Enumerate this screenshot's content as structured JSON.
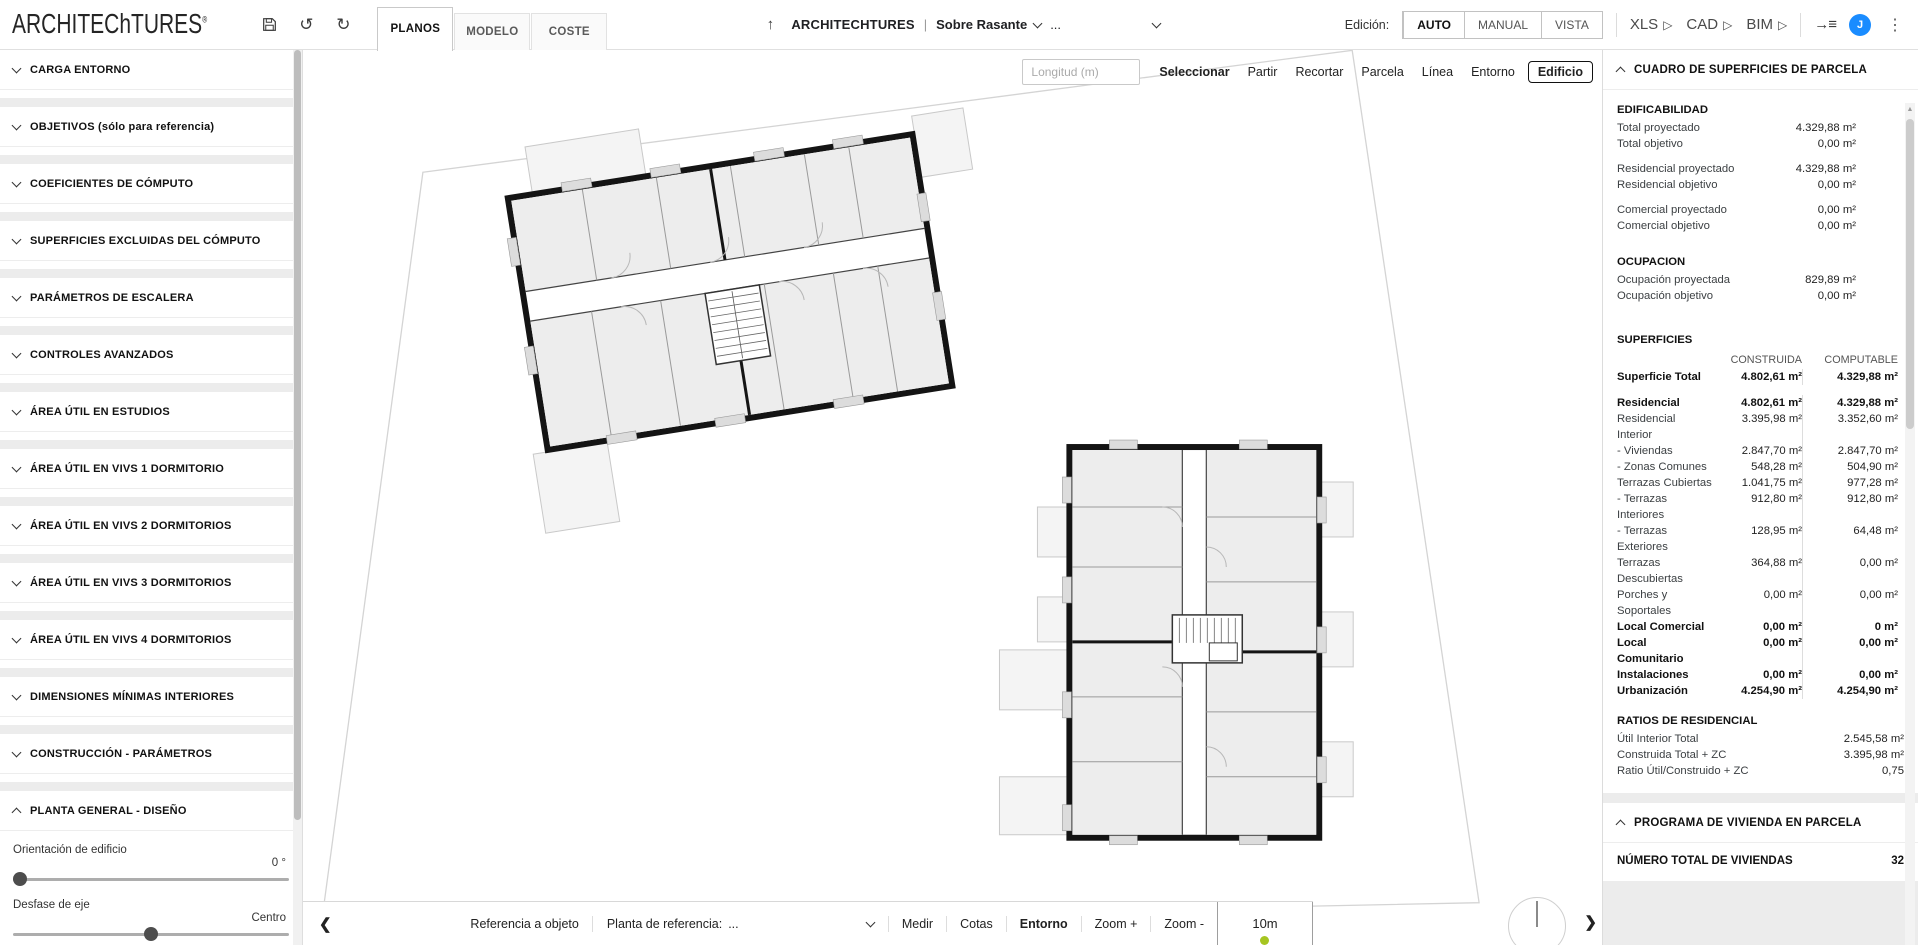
{
  "icons": {
    "up_arrow": "↑",
    "undo": "↺",
    "redo": "↻",
    "kebab": "⋮",
    "chevron_left": "❮",
    "chevron_right": "❯",
    "play": "▷",
    "arrow_right": "→",
    "list": "≡",
    "scroll_up": "▲"
  },
  "colors": {
    "avatar_blue": "#1a8cff",
    "scale_dot_green": "#a6c521",
    "wall_black": "#141414"
  },
  "topbar": {
    "logo": "ARCHITEChTURES",
    "logo_mark": "®",
    "tabs": [
      {
        "label": "PLANOS",
        "active": true
      },
      {
        "label": "MODELO",
        "active": false
      },
      {
        "label": "COSTE",
        "active": false
      }
    ],
    "project_name": "ARCHITECHTURES",
    "separator": "|",
    "level_selector": "Sobre Rasante",
    "sublevel_selector": "...",
    "edition_label": "Edición:",
    "edition_modes": [
      {
        "label": "AUTO",
        "active": true
      },
      {
        "label": "MANUAL",
        "active": false
      },
      {
        "label": "VISTA",
        "active": false
      }
    ],
    "exports": [
      {
        "label": "XLS"
      },
      {
        "label": "CAD"
      },
      {
        "label": "BIM"
      }
    ],
    "avatar_initial": "J"
  },
  "sidebar": {
    "sections": [
      {
        "label": "CARGA ENTORNO"
      },
      {
        "label": "OBJETIVOS (sólo para referencia)"
      },
      {
        "label": "COEFICIENTES DE CÓMPUTO"
      },
      {
        "label": "SUPERFICIES EXCLUIDAS DEL CÓMPUTO"
      },
      {
        "label": "PARÁMETROS DE ESCALERA"
      },
      {
        "label": "CONTROLES AVANZADOS"
      },
      {
        "label": "ÁREA ÚTIL EN ESTUDIOS"
      },
      {
        "label": "ÁREA ÚTIL EN VIVS 1 DORMITORIO"
      },
      {
        "label": "ÁREA ÚTIL EN VIVS 2 DORMITORIOS"
      },
      {
        "label": "ÁREA ÚTIL EN VIVS 3 DORMITORIOS"
      },
      {
        "label": "ÁREA ÚTIL EN VIVS 4 DORMITORIOS"
      },
      {
        "label": "DIMENSIONES MÍNIMAS INTERIORES"
      },
      {
        "label": "CONSTRUCCIÓN - PARÁMETROS"
      }
    ],
    "expanded_section": {
      "label": "PLANTA GENERAL - DISEÑO",
      "controls": [
        {
          "label": "Orientación de edificio",
          "value": "0 °"
        },
        {
          "label": "Desfase de eje",
          "value": "Centro"
        }
      ]
    }
  },
  "canvas": {
    "toolbar": {
      "length_placeholder": "Longitud (m)",
      "tools": [
        {
          "label": "Seleccionar",
          "active": true
        },
        {
          "label": "Partir"
        },
        {
          "label": "Recortar"
        },
        {
          "label": "Parcela"
        },
        {
          "label": "Línea"
        },
        {
          "label": "Entorno"
        },
        {
          "label": "Edificio",
          "boxed": true
        }
      ]
    },
    "bottombar": {
      "ref_objeto": "Referencia a objeto",
      "planta_ref_label": "Planta de referencia:",
      "planta_ref_value": "...",
      "medir": "Medir",
      "cotas": "Cotas",
      "entorno": "Entorno",
      "zoom_in": "Zoom +",
      "zoom_out": "Zoom -",
      "scale": "10m"
    }
  },
  "right_panel": {
    "surfaces_card": {
      "title": "CUADRO DE SUPERFICIES DE PARCELA",
      "edificabilidad": {
        "title": "EDIFICABILIDAD",
        "rows": [
          {
            "label": "Total proyectado",
            "value": "4.329,88 m²"
          },
          {
            "label": "Total objetivo",
            "value": "0,00 m²"
          },
          {
            "label": "Residencial proyectado",
            "value": "4.329,88 m²",
            "gap": true
          },
          {
            "label": "Residencial objetivo",
            "value": "0,00 m²"
          },
          {
            "label": "Comercial proyectado",
            "value": "0,00 m²",
            "gap": true
          },
          {
            "label": "Comercial objetivo",
            "value": "0,00 m²"
          }
        ]
      },
      "ocupacion": {
        "title": "OCUPACION",
        "rows": [
          {
            "label": "Ocupación proyectada",
            "value": "829,89 m²"
          },
          {
            "label": "Ocupación objetivo",
            "value": "0,00 m²"
          }
        ]
      },
      "superficies": {
        "title": "SUPERFICIES",
        "col1": "CONSTRUIDA",
        "col2": "COMPUTABLE",
        "rows": [
          {
            "label": "Superficie Total",
            "c": "4.802,61 m²",
            "t": "4.329,88 m²",
            "bold": true
          },
          {
            "label": "Residencial",
            "c": "4.802,61 m²",
            "t": "4.329,88 m²",
            "bold": true,
            "gap": true
          },
          {
            "label": "Residencial Interior",
            "c": "3.395,98 m²",
            "t": "3.352,60 m²"
          },
          {
            "label": "- Viviendas",
            "c": "2.847,70 m²",
            "t": "2.847,70 m²"
          },
          {
            "label": "- Zonas Comunes",
            "c": "548,28 m²",
            "t": "504,90 m²"
          },
          {
            "label": "Terrazas Cubiertas",
            "c": "1.041,75 m²",
            "t": "977,28 m²"
          },
          {
            "label": "- Terrazas Interiores",
            "c": "912,80 m²",
            "t": "912,80 m²"
          },
          {
            "label": "- Terrazas Exteriores",
            "c": "128,95 m²",
            "t": "64,48 m²"
          },
          {
            "label": "Terrazas Descubiertas",
            "c": "364,88 m²",
            "t": "0,00 m²"
          },
          {
            "label": "Porches y Soportales",
            "c": "0,00 m²",
            "t": "0,00 m²"
          },
          {
            "label": "Local Comercial",
            "c": "0,00 m²",
            "t": "0 m²",
            "bold": true
          },
          {
            "label": "Local Comunitario",
            "c": "0,00 m²",
            "t": "0,00 m²",
            "bold": true
          },
          {
            "label": "Instalaciones",
            "c": "0,00 m²",
            "t": "0,00 m²",
            "bold": true
          },
          {
            "label": "Urbanización",
            "c": "4.254,90 m²",
            "t": "4.254,90 m²",
            "bold": true
          }
        ]
      },
      "ratios": {
        "title": "RATIOS DE RESIDENCIAL",
        "rows": [
          {
            "label": "Útil Interior Total",
            "value": "2.545,58 m²"
          },
          {
            "label": "Construida Total + ZC",
            "value": "3.395,98 m²"
          },
          {
            "label": "Ratio Útil/Construido + ZC",
            "value": "0,75"
          }
        ]
      }
    },
    "program_card": {
      "title": "PROGRAMA DE VIVIENDA EN PARCELA",
      "total_label": "NÚMERO TOTAL DE VIVIENDAS",
      "total_value": "32"
    }
  }
}
